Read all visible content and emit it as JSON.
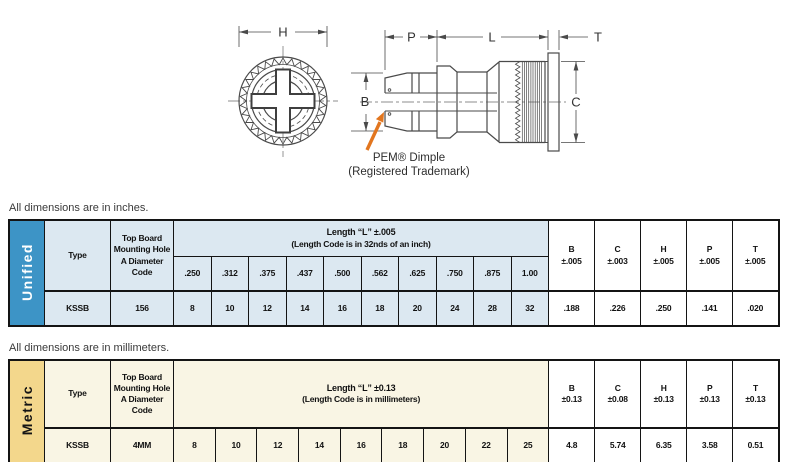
{
  "diagram": {
    "labels": {
      "h": "H",
      "p": "P",
      "l": "L",
      "t": "T",
      "b": "B",
      "c": "C"
    },
    "annotation_line1": "PEM® Dimple",
    "annotation_line2": "(Registered Trademark)",
    "arrow_color": "#e2761f",
    "line_color": "#4a4a4a"
  },
  "unified": {
    "note": "All dimensions are in inches.",
    "side_label": "Unified",
    "side_label_bg": "#3d94c6",
    "cell_bg": "#dce8f1",
    "headers": {
      "type": "Type",
      "hole": "Top Board Mounting Hole A Diameter Code",
      "length_title": "Length “L” ±.005",
      "length_sub": "(Length Code is in 32nds of an inch)",
      "lengths": [
        ".250",
        ".312",
        ".375",
        ".437",
        ".500",
        ".562",
        ".625",
        ".750",
        ".875",
        "1.00"
      ],
      "dims": [
        {
          "name": "B",
          "tol": "±.005"
        },
        {
          "name": "C",
          "tol": "±.003"
        },
        {
          "name": "H",
          "tol": "±.005"
        },
        {
          "name": "P",
          "tol": "±.005"
        },
        {
          "name": "T",
          "tol": "±.005"
        }
      ]
    },
    "row": {
      "type": "KSSB",
      "hole": "156",
      "codes": [
        "8",
        "10",
        "12",
        "14",
        "16",
        "18",
        "20",
        "24",
        "28",
        "32"
      ],
      "dims": [
        ".188",
        ".226",
        ".250",
        ".141",
        ".020"
      ]
    }
  },
  "metric": {
    "note": "All dimensions are in millimeters.",
    "side_label": "Metric",
    "side_label_bg": "#f3d78c",
    "cell_bg": "#f9f5e4",
    "headers": {
      "type": "Type",
      "hole": "Top Board Mounting Hole A Diameter Code",
      "length_title": "Length “L” ±0.13",
      "length_sub": "(Length Code is in millimeters)",
      "dims": [
        {
          "name": "B",
          "tol": "±0.13"
        },
        {
          "name": "C",
          "tol": "±0.08"
        },
        {
          "name": "H",
          "tol": "±0.13"
        },
        {
          "name": "P",
          "tol": "±0.13"
        },
        {
          "name": "T",
          "tol": "±0.13"
        }
      ]
    },
    "row": {
      "type": "KSSB",
      "hole": "4MM",
      "codes": [
        "8",
        "10",
        "12",
        "14",
        "16",
        "18",
        "20",
        "22",
        "25"
      ],
      "dims": [
        "4.8",
        "5.74",
        "6.35",
        "3.58",
        "0.51"
      ]
    }
  }
}
